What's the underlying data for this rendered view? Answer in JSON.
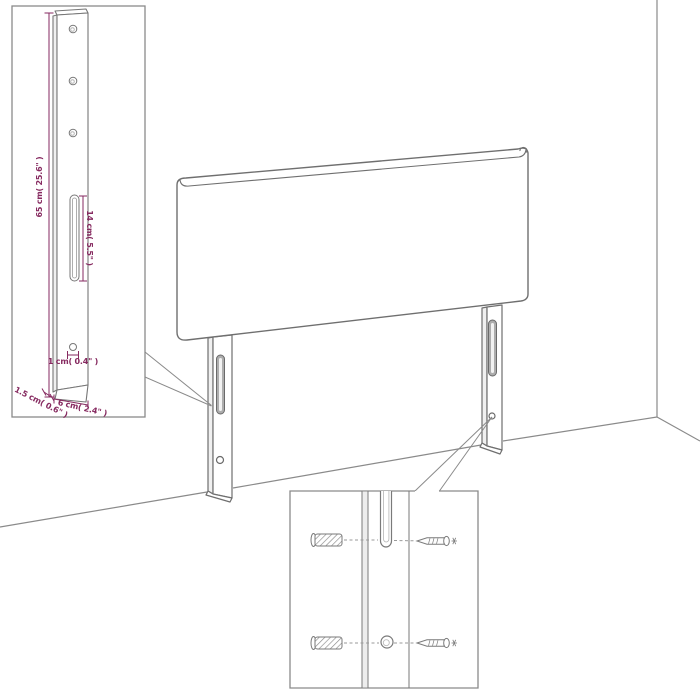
{
  "colors": {
    "furniture_outline": "#6f6f6f",
    "wall_line": "#8a8a8a",
    "inset_border": "#8a8a8a",
    "dimension": "#862a60",
    "slot_fill": "#adadad",
    "background": "#ffffff"
  },
  "scene": {
    "object": "headboard",
    "leg_count": 2,
    "slots_per_leg": 1,
    "holes_per_leg": 1
  },
  "leg_detail_inset": {
    "hole_count": 3,
    "dim_height_label": "65 cm( 25.6\" )",
    "dim_slot_label": "14 cm( 5.5\" )",
    "dim_hole_label": "1 cm( 0.4\" )",
    "dim_thickness_label": "1.5 cm( 0.6\" )",
    "dim_width_label": "6 cm( 2.4\" )"
  },
  "mounting_detail_inset": {
    "wall_plug_count": 2,
    "screw_count": 2,
    "icons": [
      "wall-plug-icon",
      "screw-icon",
      "mounting-slot",
      "mounting-hole"
    ]
  }
}
